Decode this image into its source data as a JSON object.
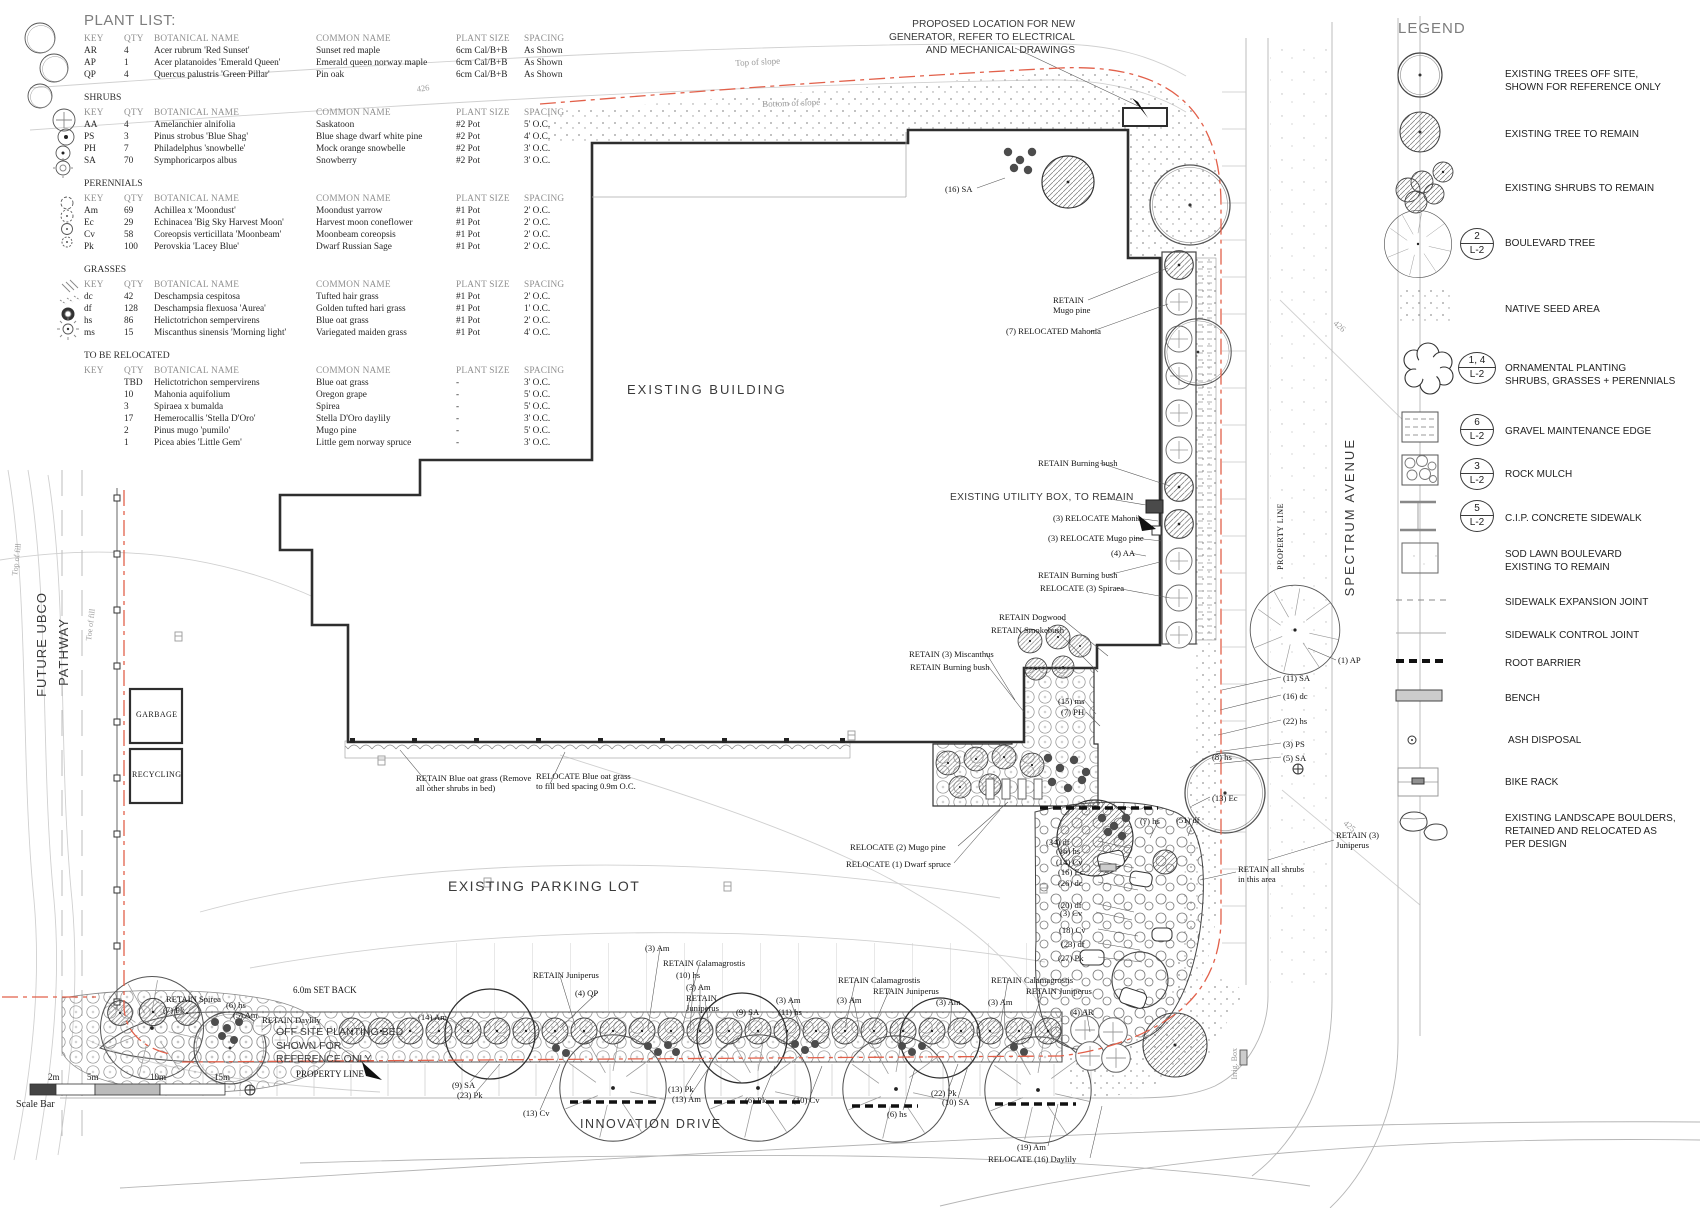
{
  "plant_list": {
    "title": "PLANT LIST:",
    "columns": [
      "KEY",
      "QTY",
      "BOTANICAL NAME",
      "COMMON NAME",
      "PLANT SIZE",
      "SPACING"
    ],
    "trees": {
      "rows": [
        [
          "AR",
          "4",
          "Acer rubrum 'Red Sunset'",
          "Sunset red maple",
          "6cm Cal/B+B",
          "As Shown"
        ],
        [
          "AP",
          "1",
          "Acer platanoides 'Emerald Queen'",
          "Emerald queen norway maple",
          "6cm Cal/B+B",
          "As Shown"
        ],
        [
          "QP",
          "4",
          "Quercus palustris 'Green Pillar'",
          "Pin oak",
          "6cm Cal/B+B",
          "As Shown"
        ]
      ]
    },
    "shrubs": {
      "heading": "SHRUBS",
      "rows": [
        [
          "AA",
          "4",
          "Amelanchier alnifolia",
          "Saskatoon",
          "#2 Pot",
          "5' O.C."
        ],
        [
          "PS",
          "3",
          "Pinus strobus 'Blue Shag'",
          "Blue shage dwarf white pine",
          "#2 Pot",
          "4' O.C."
        ],
        [
          "PH",
          "7",
          "Philadelphus 'snowbelle'",
          "Mock orange snowbelle",
          "#2 Pot",
          "3' O.C."
        ],
        [
          "SA",
          "70",
          "Symphoricarpos albus",
          "Snowberry",
          "#2 Pot",
          "3' O.C."
        ]
      ]
    },
    "perennials": {
      "heading": "PERENNIALS",
      "rows": [
        [
          "Am",
          "69",
          "Achillea x 'Moondust'",
          "Moondust yarrow",
          "#1 Pot",
          "2' O.C."
        ],
        [
          "Ec",
          "29",
          "Echinacea 'Big Sky Harvest Moon'",
          "Harvest moon coneflower",
          "#1 Pot",
          "2' O.C."
        ],
        [
          "Cv",
          "58",
          "Coreopsis verticillata 'Moonbeam'",
          "Moonbeam coreopsis",
          "#1 Pot",
          "2' O.C."
        ],
        [
          "Pk",
          "100",
          "Perovskia 'Lacey Blue'",
          "Dwarf Russian Sage",
          "#1 Pot",
          "2' O.C."
        ]
      ]
    },
    "grasses": {
      "heading": "GRASSES",
      "rows": [
        [
          "dc",
          "42",
          "Deschampsia cespitosa",
          "Tufted hair grass",
          "#1 Pot",
          "2' O.C."
        ],
        [
          "df",
          "128",
          "Deschampsia flexuosa 'Aurea'",
          "Golden tufted hari grass",
          "#1 Pot",
          "1' O.C."
        ],
        [
          "hs",
          "86",
          "Helictotrichon sempervirens",
          "Blue oat grass",
          "#1 Pot",
          "2' O.C."
        ],
        [
          "ms",
          "15",
          "Miscanthus sinensis 'Morning light'",
          "Variegated maiden grass",
          "#1 Pot",
          "4' O.C."
        ]
      ]
    },
    "relocated": {
      "heading": "TO BE RELOCATED",
      "rows": [
        [
          "",
          "TBD",
          "Helictotrichon sempervirens",
          "Blue oat grass",
          "-",
          "3' O.C."
        ],
        [
          "",
          "10",
          "Mahonia aquifolium",
          "Oregon grape",
          "-",
          "5' O.C."
        ],
        [
          "",
          "3",
          "Spiraea x bumalda",
          "Spirea",
          "-",
          "5' O.C."
        ],
        [
          "",
          "17",
          "Hemerocallis 'Stella D'Oro'",
          "Stella D'Oro daylily",
          "-",
          "3' O.C."
        ],
        [
          "",
          "2",
          "Pinus mugo 'pumilo'",
          "Mugo pine",
          "-",
          "5' O.C."
        ],
        [
          "",
          "1",
          "Picea abies 'Little Gem'",
          "Little gem norway spruce",
          "-",
          "3' O.C."
        ]
      ]
    }
  },
  "legend": {
    "title": "LEGEND",
    "items": [
      {
        "label": "EXISTING TREES OFF SITE,\nSHOWN FOR REFERENCE ONLY"
      },
      {
        "label": "EXISTING TREE TO REMAIN"
      },
      {
        "label": "EXISTING SHRUBS TO REMAIN"
      },
      {
        "label": "BOULEVARD TREE",
        "callout_top": "2",
        "callout_bottom": "L-2"
      },
      {
        "label": "NATIVE SEED AREA"
      },
      {
        "label": "ORNAMENTAL PLANTING\nSHRUBS, GRASSES + PERENNIALS",
        "callout_top": "1, 4",
        "callout_bottom": "L-2"
      },
      {
        "label": "GRAVEL MAINTENANCE EDGE",
        "callout_top": "6",
        "callout_bottom": "L-2"
      },
      {
        "label": "ROCK MULCH",
        "callout_top": "3",
        "callout_bottom": "L-2"
      },
      {
        "label": "C.I.P. CONCRETE SIDEWALK",
        "callout_top": "5",
        "callout_bottom": "L-2"
      },
      {
        "label": "SOD LAWN BOULEVARD\nEXISTING TO REMAIN"
      },
      {
        "label": "SIDEWALK EXPANSION JOINT"
      },
      {
        "label": "SIDEWALK CONTROL JOINT"
      },
      {
        "label": "ROOT BARRIER"
      },
      {
        "label": "BENCH"
      },
      {
        "label": "ASH DISPOSAL"
      },
      {
        "label": "BIKE RACK"
      },
      {
        "label": "EXISTING LANDSCAPE BOULDERS,\nRETAINED AND RELOCATED AS\nPER DESIGN"
      }
    ]
  },
  "plan": {
    "building_label": "EXISTING BUILDING",
    "parking_label": "EXISTING PARKING LOT",
    "spectrum_label": "SPECTRUM AVENUE",
    "innovation_label": "INNOVATION DRIVE",
    "pathway_label_1": "FUTURE UBCO",
    "pathway_label_2": "PATHWAY",
    "property_line_vertical": "PROPERTY LINE",
    "garbage_label": "GARBAGE",
    "recycling_label": "RECYCLING",
    "generator_note": "PROPOSED LOCATION FOR NEW\nGENERATOR, REFER TO ELECTRICAL\nAND MECHANICAL DRAWINGS",
    "utility_note": "EXISTING UTILITY BOX, TO REMAIN",
    "offsite_note": "OFF SITE PLANTING BED\nSHOWN FOR\nREFERENCE ONLY",
    "top_of_slope": "Top of slope",
    "bottom_of_slope": "Bottom of slope",
    "top_of_fill": "Top of fill",
    "toe_of_fill": "Toe of fill",
    "irrig_box": "Irrig. Box",
    "contour_426": "426",
    "contour_425": "425",
    "annotations": [
      "(16) SA",
      "RETAIN\nMugo pine",
      "(7) RELOCATED Mahonia",
      "RETAIN Burning bush",
      "(3) RELOCATE Mahonia",
      "(3) RELOCATE Mugo pine",
      "(4) AA",
      "RETAIN Burning bush",
      "RELOCATE (3) Spiraea",
      "RETAIN Dogwood",
      "RETAIN Smokebush",
      "RETAIN (3) Miscanthus",
      "RETAIN Burning bush",
      "(15) ms",
      "(7) PH",
      "(1) AP",
      "(11) SA",
      "(16) dc",
      "(22) hs",
      "(3) PS",
      "(5) SA",
      "RETAIN (3)\nJuniperus",
      "RETAIN all shrubs\nin this area",
      "(8) hs",
      "(13) Ec",
      "(7) hs",
      "(51) df",
      "(34) df",
      "(16) hs",
      "(14) Cv",
      "(16) Ec",
      "(26) dc",
      "(20) df",
      "(3) Cv",
      "(18) Cv",
      "(23) df",
      "(27) Pk",
      "RELOCATE (2) Mugo pine",
      "RELOCATE (1) Dwarf spruce",
      "(19) Am",
      "RELOCATE (16) Daylily",
      "(14) Am",
      "RETAIN Juniperus",
      "(4) QP",
      "(3) Am",
      "RETAIN Calamagrostis",
      "(10) hs",
      "(3) Am",
      "RETAIN\nJuniperus",
      "(9) SA",
      "(3) Am",
      "(11) hs",
      "(9) SA",
      "(23) Pk",
      "(13) Cv",
      "(13) Pk",
      "(13) Am",
      "(6) Pk",
      "(10) Cv",
      "(10) SA",
      "(22) Pk",
      "(6) hs",
      "RETAIN Calamagrostis",
      "RETAIN Juniperus",
      "(3) Am",
      "RETAIN Calamagrostis",
      "RETAIN Juniperus",
      "(3) Am",
      "(3) Am",
      "(4) AR",
      "RETAIN Spirea",
      "(7) Pk",
      "(6) hs",
      "(5) Am",
      "RETAIN Daylily",
      "6.0m SET BACK",
      "PROPERTY LINE",
      "RETAIN Blue oat grass (Remove\nall other shrubs in bed)",
      "RELOCATE Blue oat grass\nto fill bed spacing 0.9m O.C."
    ]
  },
  "scale_bar": {
    "label": "Scale Bar",
    "ticks": [
      "2m",
      "5m",
      "10m",
      "15m"
    ]
  }
}
